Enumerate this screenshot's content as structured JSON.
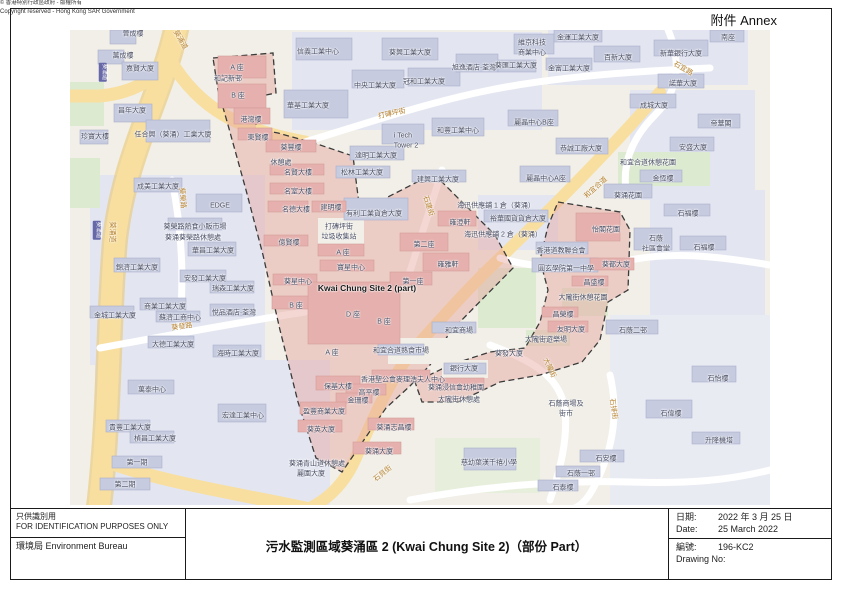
{
  "page": {
    "annex_label": "附件 Annex"
  },
  "footer": {
    "disclaimer_zh": "只供識別用",
    "disclaimer_en": "FOR IDENTIFICATION PURPOSES ONLY",
    "bureau": "環境局 Environment Bureau",
    "copyright_zh": "© 香港特別行政區政府 - 版權所有",
    "copyright_en": "Copyright reserved - Hong Kong SAR Government",
    "title": "污水監測區域葵涌區 2 (Kwai Chung Site 2)（部份 Part）",
    "date_label_zh": "日期:",
    "date_value_zh": "2022 年 3 月 25 日",
    "date_label_en": "Date:",
    "date_value_en": "25 March 2022",
    "no_label_zh": "編號:",
    "drawing_no": "196-KC2",
    "no_label_en": "Drawing No:"
  },
  "map": {
    "site_label": "Kwai Chung Site 2 (part)",
    "colors": {
      "zone_fill": "#e7a39e",
      "zone_border": "#3a3a3a",
      "road_major": "#f8dfa0",
      "road_label": "#b5802d",
      "building": "#c6cbdf",
      "building_zone": "#e5b0ad",
      "park": "#dcead0",
      "background": "#f1efe7",
      "route_badge": "#6668a8"
    },
    "labels": [
      {
        "t": "晉成樓",
        "x": 63,
        "y": 4,
        "c": "b"
      },
      {
        "t": "萬成樓",
        "x": 53,
        "y": 26,
        "c": "b"
      },
      {
        "t": "嘉賢大廈",
        "x": 70,
        "y": 39,
        "c": "b"
      },
      {
        "t": "昌年大廈",
        "x": 62,
        "y": 81,
        "c": "b"
      },
      {
        "t": "珍寶大樓",
        "x": 25,
        "y": 107,
        "c": "b"
      },
      {
        "t": "任合興（葵涌）工業大廈",
        "x": 103,
        "y": 105,
        "c": "b"
      },
      {
        "t": "成美工業大廈",
        "x": 88,
        "y": 157,
        "c": "b"
      },
      {
        "t": "EDGE",
        "x": 150,
        "y": 176,
        "c": "b"
      },
      {
        "t": "葵榮路熱食小販市場",
        "x": 125,
        "y": 197,
        "c": "b"
      },
      {
        "t": "葵涌葵榮路休憩處",
        "x": 123,
        "y": 208,
        "c": "b"
      },
      {
        "t": "華昌工業大廈",
        "x": 143,
        "y": 221,
        "c": "b"
      },
      {
        "t": "錦濟工業大廈",
        "x": 67,
        "y": 238,
        "c": "b"
      },
      {
        "t": "安發工業大廈",
        "x": 135,
        "y": 249,
        "c": "b"
      },
      {
        "t": "瑞森工業大廈",
        "x": 163,
        "y": 259,
        "c": "b"
      },
      {
        "t": "商業工業大廈",
        "x": 95,
        "y": 277,
        "c": "b"
      },
      {
        "t": "蘇濟工商中心",
        "x": 110,
        "y": 288,
        "c": "b"
      },
      {
        "t": "金城工業大廈",
        "x": 45,
        "y": 286,
        "c": "b"
      },
      {
        "t": "悅品酒店·荃灣",
        "x": 164,
        "y": 283,
        "c": "b"
      },
      {
        "t": "大德工業大廈",
        "x": 103,
        "y": 315,
        "c": "b"
      },
      {
        "t": "海時工業大廈",
        "x": 168,
        "y": 324,
        "c": "b"
      },
      {
        "t": "萬泰中心",
        "x": 82,
        "y": 360,
        "c": "b"
      },
      {
        "t": "宏達工業中心",
        "x": 173,
        "y": 386,
        "c": "b"
      },
      {
        "t": "貴豐工業大廈",
        "x": 60,
        "y": 398,
        "c": "b"
      },
      {
        "t": "楨昌工業大廈",
        "x": 85,
        "y": 409,
        "c": "b"
      },
      {
        "t": "第一期",
        "x": 67,
        "y": 433,
        "c": "b"
      },
      {
        "t": "第二期",
        "x": 55,
        "y": 455,
        "c": "b"
      },
      {
        "t": "信義工業中心",
        "x": 248,
        "y": 22,
        "c": "b"
      },
      {
        "t": "葵興工業大廈",
        "x": 340,
        "y": 23,
        "c": "b"
      },
      {
        "t": "中央工業大廈",
        "x": 305,
        "y": 56,
        "c": "b"
      },
      {
        "t": "冠和工業大廈",
        "x": 354,
        "y": 52,
        "c": "b"
      },
      {
        "t": "旭逸酒店·荃灣",
        "x": 404,
        "y": 38,
        "c": "b"
      },
      {
        "t": "維京科技",
        "x": 462,
        "y": 13,
        "c": "b"
      },
      {
        "t": "商業中心",
        "x": 462,
        "y": 23,
        "c": "b"
      },
      {
        "t": "葵匯工業大廈",
        "x": 446,
        "y": 36,
        "c": "b"
      },
      {
        "t": "華基工業大廈",
        "x": 238,
        "y": 76,
        "c": "b"
      },
      {
        "t": "i Tech",
        "x": 333,
        "y": 106,
        "c": "b"
      },
      {
        "t": "Tower 2",
        "x": 336,
        "y": 116,
        "c": "b"
      },
      {
        "t": "和豐工業中心",
        "x": 388,
        "y": 101,
        "c": "b"
      },
      {
        "t": "達明工業大廈",
        "x": 306,
        "y": 126,
        "c": "b"
      },
      {
        "t": "松林工業大廈",
        "x": 292,
        "y": 143,
        "c": "b"
      },
      {
        "t": "建興工業大廈",
        "x": 368,
        "y": 150,
        "c": "b"
      },
      {
        "t": "有利工業貨倉大廈",
        "x": 304,
        "y": 184,
        "c": "b"
      },
      {
        "t": "麗晶中心B座",
        "x": 464,
        "y": 93,
        "c": "b"
      },
      {
        "t": "麗晶中心A座",
        "x": 476,
        "y": 149,
        "c": "b"
      },
      {
        "t": "金運工業大廈",
        "x": 508,
        "y": 8,
        "c": "b"
      },
      {
        "t": "百新大廈",
        "x": 548,
        "y": 28,
        "c": "b"
      },
      {
        "t": "新華銀行大廈",
        "x": 611,
        "y": 24,
        "c": "b"
      },
      {
        "t": "南座",
        "x": 658,
        "y": 8,
        "c": "b"
      },
      {
        "t": "諾華大廈",
        "x": 613,
        "y": 54,
        "c": "b"
      },
      {
        "t": "金富工業大廈",
        "x": 499,
        "y": 39,
        "c": "b"
      },
      {
        "t": "成城大廈",
        "x": 584,
        "y": 76,
        "c": "b"
      },
      {
        "t": "帝華閣",
        "x": 651,
        "y": 94,
        "c": "b"
      },
      {
        "t": "恭誠工廠大廈",
        "x": 511,
        "y": 119,
        "c": "b"
      },
      {
        "t": "安盛大廈",
        "x": 623,
        "y": 118,
        "c": "b"
      },
      {
        "t": "和宜合道休憩花園",
        "x": 578,
        "y": 133,
        "c": "b"
      },
      {
        "t": "金恆樓",
        "x": 593,
        "y": 149,
        "c": "b"
      },
      {
        "t": "葵涌花園",
        "x": 558,
        "y": 166,
        "c": "b"
      },
      {
        "t": "石福樓",
        "x": 618,
        "y": 184,
        "c": "b"
      },
      {
        "t": "石福樓",
        "x": 634,
        "y": 218,
        "c": "b"
      },
      {
        "t": "石蔭",
        "x": 586,
        "y": 209,
        "c": "b"
      },
      {
        "t": "社區會堂",
        "x": 586,
        "y": 219,
        "c": "b"
      },
      {
        "t": "香港道教聯合會",
        "x": 491,
        "y": 221,
        "c": "b"
      },
      {
        "t": "圓玄學院第一中學",
        "x": 496,
        "y": 239,
        "c": "b"
      },
      {
        "t": "石蔭二邨",
        "x": 563,
        "y": 301,
        "c": "b"
      },
      {
        "t": "石蔭商場及",
        "x": 496,
        "y": 374,
        "c": "b"
      },
      {
        "t": "街市",
        "x": 496,
        "y": 384,
        "c": "b"
      },
      {
        "t": "石怡樓",
        "x": 648,
        "y": 349,
        "c": "b"
      },
      {
        "t": "石偉樓",
        "x": 601,
        "y": 384,
        "c": "b"
      },
      {
        "t": "升降機塔",
        "x": 649,
        "y": 411,
        "c": "b"
      },
      {
        "t": "石安樓",
        "x": 536,
        "y": 429,
        "c": "b"
      },
      {
        "t": "石蔭一邨",
        "x": 511,
        "y": 444,
        "c": "b"
      },
      {
        "t": "石泰樓",
        "x": 493,
        "y": 458,
        "c": "b"
      },
      {
        "t": "慈幼葉漢千禧小學",
        "x": 419,
        "y": 433,
        "c": "b"
      },
      {
        "t": "和宜合道熟食市場",
        "x": 331,
        "y": 321,
        "c": "b"
      },
      {
        "t": "銀行大廈",
        "x": 394,
        "y": 339,
        "c": "b"
      },
      {
        "t": "和宜商場",
        "x": 389,
        "y": 301,
        "c": "b"
      },
      {
        "t": "葵發大廈",
        "x": 439,
        "y": 324,
        "c": "b"
      },
      {
        "t": "裕華國貨貨倉大廈",
        "x": 448,
        "y": 189,
        "c": "b"
      },
      {
        "t": "海迅供應鋪 1 倉（葵涌）",
        "x": 426,
        "y": 176,
        "c": "b"
      },
      {
        "t": "海迅供應鋪 2 倉（葵涌）",
        "x": 433,
        "y": 205,
        "c": "b"
      },
      {
        "t": "葵涌青山道休憩處",
        "x": 247,
        "y": 434,
        "c": "b"
      },
      {
        "t": "麗園大廈",
        "x": 241,
        "y": 444,
        "c": "b"
      },
      {
        "t": "A 座",
        "x": 167,
        "y": 38,
        "c": "b"
      },
      {
        "t": "和記新邨",
        "x": 158,
        "y": 49,
        "c": "b"
      },
      {
        "t": "B 座",
        "x": 168,
        "y": 66,
        "c": "b"
      },
      {
        "t": "港灣樓",
        "x": 181,
        "y": 90,
        "c": "b"
      },
      {
        "t": "東賢樓",
        "x": 188,
        "y": 108,
        "c": "b"
      },
      {
        "t": "葵豐樓",
        "x": 221,
        "y": 118,
        "c": "b"
      },
      {
        "t": "休憩處",
        "x": 211,
        "y": 133,
        "c": "b"
      },
      {
        "t": "名賢大樓",
        "x": 228,
        "y": 143,
        "c": "b"
      },
      {
        "t": "名室大樓",
        "x": 228,
        "y": 162,
        "c": "b"
      },
      {
        "t": "名德大樓",
        "x": 226,
        "y": 180,
        "c": "b"
      },
      {
        "t": "建明樓",
        "x": 261,
        "y": 178,
        "c": "b"
      },
      {
        "t": "打磚坪街",
        "x": 269,
        "y": 197,
        "c": "b"
      },
      {
        "t": "垃圾收集站",
        "x": 269,
        "y": 207,
        "c": "b"
      },
      {
        "t": "億賢樓",
        "x": 219,
        "y": 213,
        "c": "b"
      },
      {
        "t": "A 座",
        "x": 273,
        "y": 223,
        "c": "b"
      },
      {
        "t": "寶星中心",
        "x": 281,
        "y": 238,
        "c": "b"
      },
      {
        "t": "葵星中心",
        "x": 228,
        "y": 252,
        "c": "b"
      },
      {
        "t": "B 座",
        "x": 226,
        "y": 276,
        "c": "b"
      },
      {
        "t": "第二座",
        "x": 354,
        "y": 215,
        "c": "b"
      },
      {
        "t": "雍澄軒",
        "x": 390,
        "y": 193,
        "c": "b"
      },
      {
        "t": "雍雅軒",
        "x": 378,
        "y": 235,
        "c": "b"
      },
      {
        "t": "第一座",
        "x": 343,
        "y": 252,
        "c": "b"
      },
      {
        "t": "D 座",
        "x": 283,
        "y": 285,
        "c": "b"
      },
      {
        "t": "B 座",
        "x": 314,
        "y": 292,
        "c": "b"
      },
      {
        "t": "A 座",
        "x": 262,
        "y": 323,
        "c": "b"
      },
      {
        "t": "保基大樓",
        "x": 268,
        "y": 357,
        "c": "b"
      },
      {
        "t": "高平樓",
        "x": 299,
        "y": 363,
        "c": "b"
      },
      {
        "t": "金珊樓",
        "x": 288,
        "y": 371,
        "c": "b"
      },
      {
        "t": "盈豐商業大廈",
        "x": 254,
        "y": 382,
        "c": "b"
      },
      {
        "t": "香港聖公會麥理浩夫人中心",
        "x": 333,
        "y": 350,
        "c": "b"
      },
      {
        "t": "葵英大廈",
        "x": 251,
        "y": 400,
        "c": "b"
      },
      {
        "t": "葵涌志昌樓",
        "x": 324,
        "y": 398,
        "c": "b"
      },
      {
        "t": "葵涌大廈",
        "x": 309,
        "y": 422,
        "c": "b"
      },
      {
        "t": "葵涌浸信會幼稚園",
        "x": 386,
        "y": 358,
        "c": "b"
      },
      {
        "t": "大隴街休憩處",
        "x": 389,
        "y": 370,
        "c": "b"
      },
      {
        "t": "怡閣花園",
        "x": 536,
        "y": 200,
        "c": "b"
      },
      {
        "t": "葵都大廈",
        "x": 546,
        "y": 235,
        "c": "b"
      },
      {
        "t": "昌盛樓",
        "x": 524,
        "y": 253,
        "c": "b"
      },
      {
        "t": "大隴街休憩花園",
        "x": 513,
        "y": 268,
        "c": "b"
      },
      {
        "t": "昌榮樓",
        "x": 493,
        "y": 285,
        "c": "b"
      },
      {
        "t": "友明大廈",
        "x": 501,
        "y": 300,
        "c": "b"
      },
      {
        "t": "大隴街遊樂場",
        "x": 476,
        "y": 310,
        "c": "b"
      },
      {
        "t": "Kwai Chung Site 2 (part)",
        "x": 297,
        "y": 258,
        "c": "s"
      },
      {
        "t": "葵涌道",
        "x": 110,
        "y": 10,
        "c": "r",
        "r": 60
      },
      {
        "t": "葵涌道",
        "x": 42,
        "y": 202,
        "c": "r",
        "r": 90
      },
      {
        "t": "葵榮路",
        "x": 112,
        "y": 168,
        "c": "r",
        "r": 85
      },
      {
        "t": "葵發路",
        "x": 112,
        "y": 297,
        "c": "r",
        "r": -8
      },
      {
        "t": "打磚坪街",
        "x": 322,
        "y": 84,
        "c": "r",
        "r": -12
      },
      {
        "t": "石宜路",
        "x": 613,
        "y": 39,
        "c": "r",
        "r": 30
      },
      {
        "t": "和宜合道",
        "x": 526,
        "y": 158,
        "c": "r",
        "r": -42
      },
      {
        "t": "石建街",
        "x": 358,
        "y": 176,
        "c": "r",
        "r": 72
      },
      {
        "t": "石貝街",
        "x": 313,
        "y": 444,
        "c": "r",
        "r": -38
      },
      {
        "t": "大隴街",
        "x": 479,
        "y": 338,
        "c": "r",
        "r": 65
      },
      {
        "t": "石排街",
        "x": 543,
        "y": 379,
        "c": "r",
        "r": 82
      },
      {
        "t": "葵涌道",
        "x": 33,
        "y": 42,
        "c": "badge",
        "r": 90
      },
      {
        "t": "葵涌道",
        "x": 27,
        "y": 200,
        "c": "badge",
        "r": 90
      }
    ]
  }
}
